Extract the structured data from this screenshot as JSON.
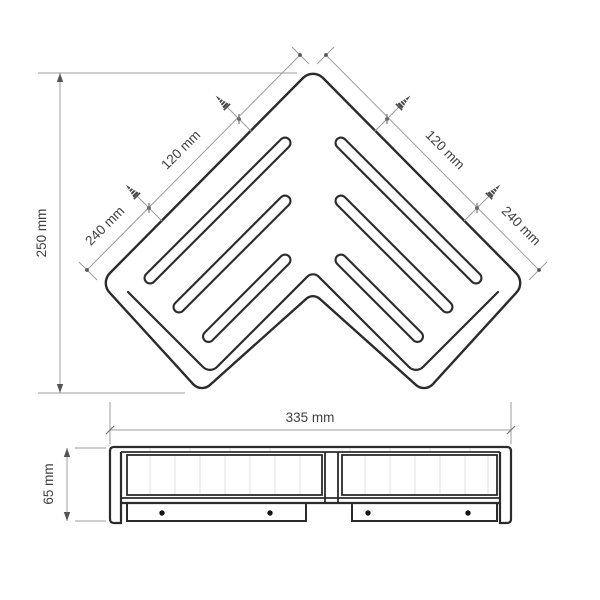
{
  "drawing": {
    "type": "product-dimension-diagram",
    "subject": "corner shelf with drainage slots (top view and front elevation)",
    "views": {
      "top": {
        "dimensions": {
          "depth_left": "240 mm",
          "screw_spacing_left": "120 mm",
          "screw_spacing_right": "120 mm",
          "depth_right": "240 mm",
          "overall_height": "250 mm"
        },
        "slot_count": 6,
        "screw_marker_count": 4,
        "icons": {
          "screw": "self-tapping-screw-marker"
        }
      },
      "side": {
        "dimensions": {
          "overall_width": "335 mm",
          "overall_height": "65 mm"
        },
        "screw_hole_count": 4
      }
    },
    "colors": {
      "background": "#ffffff",
      "line": "#2b2b2b",
      "dim_line": "#9c9c9c",
      "text": "#3f3f3f"
    }
  }
}
